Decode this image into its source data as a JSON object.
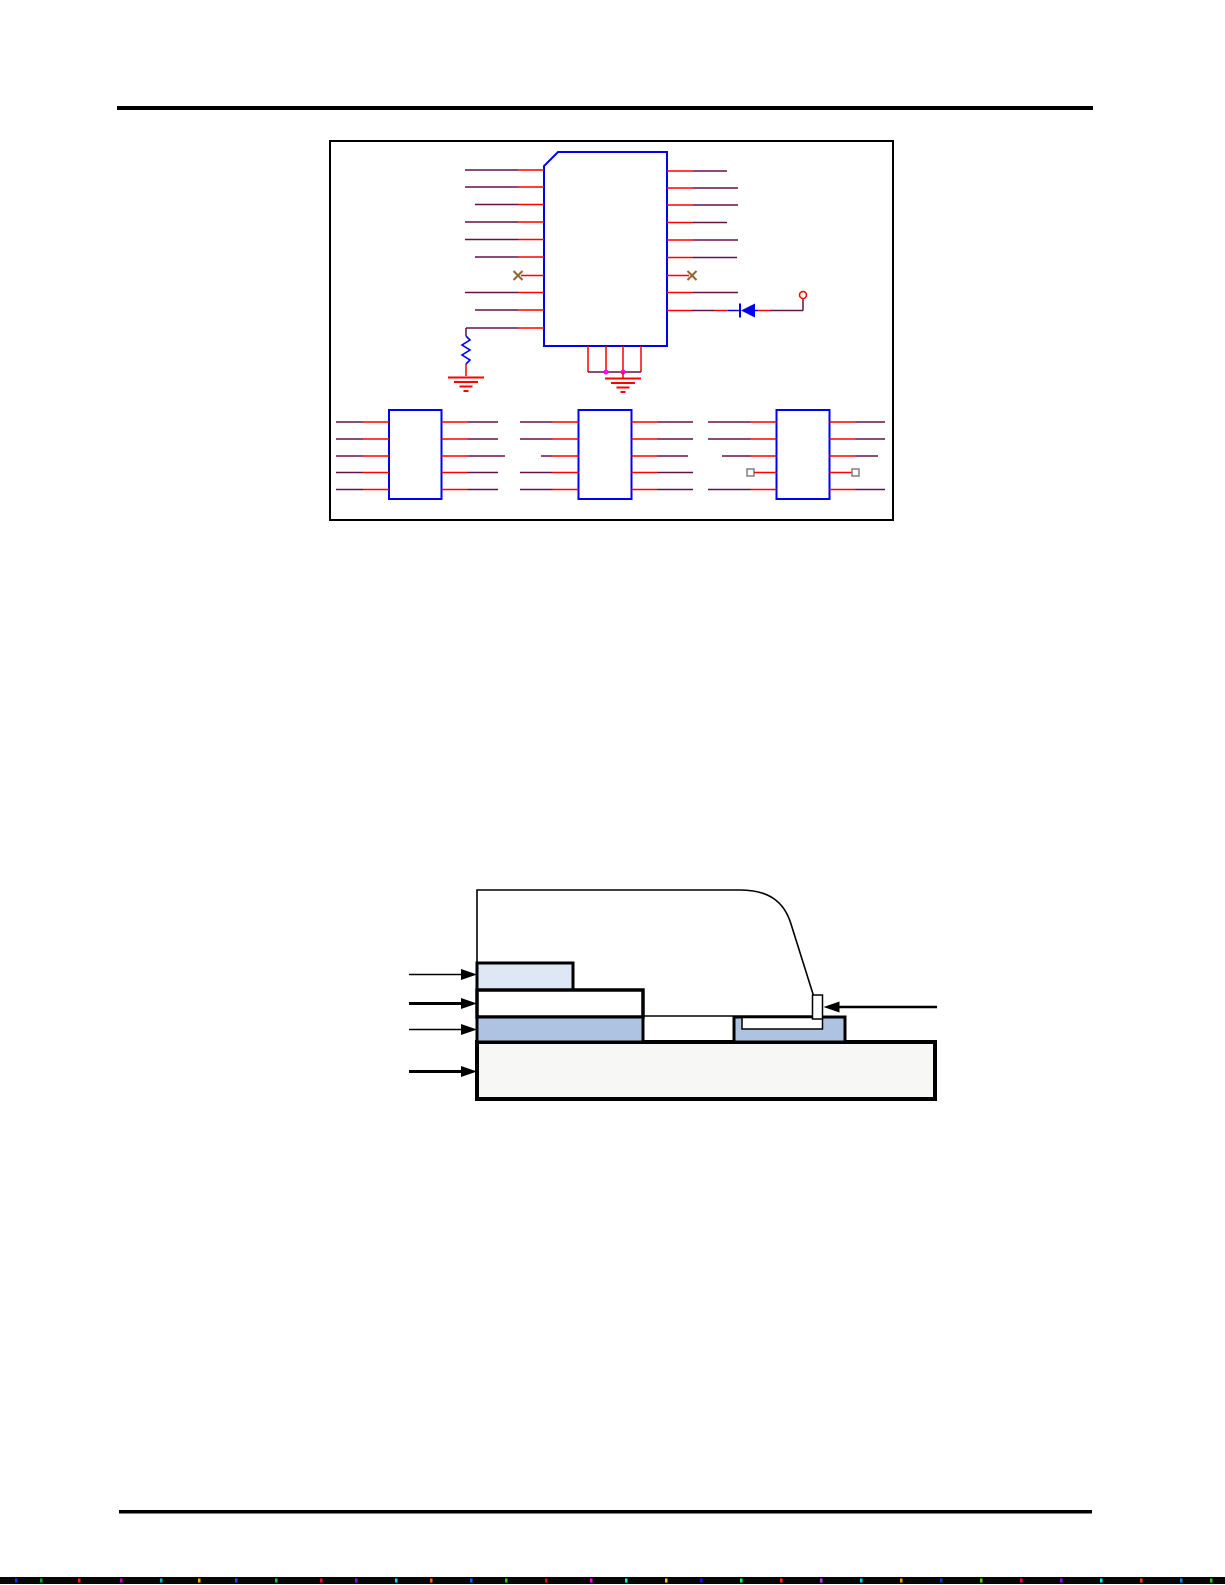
{
  "page": {
    "width": 1225,
    "height": 1585,
    "background": "#ffffff",
    "top_rule": {
      "x": 117,
      "y": 106,
      "w": 976,
      "h": 4,
      "color": "#000000"
    },
    "bottom_rule": {
      "x": 119,
      "y": 1510,
      "w": 973,
      "h": 3.5,
      "color": "#000000"
    },
    "noise_bar": {
      "x": 0,
      "y": 1577,
      "w": 1225,
      "h": 7,
      "color": "#060606",
      "specks": [
        {
          "x": 15,
          "c": "#0033ff"
        },
        {
          "x": 40,
          "c": "#00aa33"
        },
        {
          "x": 78,
          "c": "#ff2200"
        },
        {
          "x": 120,
          "c": "#cc00cc"
        },
        {
          "x": 160,
          "c": "#00bbbb"
        },
        {
          "x": 198,
          "c": "#ffaa00"
        },
        {
          "x": 235,
          "c": "#2244ff"
        },
        {
          "x": 275,
          "c": "#00cc44"
        },
        {
          "x": 320,
          "c": "#ff0044"
        },
        {
          "x": 355,
          "c": "#8800ff"
        },
        {
          "x": 395,
          "c": "#00ddff"
        },
        {
          "x": 430,
          "c": "#ff6600"
        },
        {
          "x": 470,
          "c": "#0066ff"
        },
        {
          "x": 505,
          "c": "#33cc00"
        },
        {
          "x": 545,
          "c": "#ff0000"
        },
        {
          "x": 590,
          "c": "#ff00ff"
        },
        {
          "x": 625,
          "c": "#00ffcc"
        },
        {
          "x": 665,
          "c": "#ffcc00"
        },
        {
          "x": 700,
          "c": "#3300ff"
        },
        {
          "x": 740,
          "c": "#00ff66"
        },
        {
          "x": 780,
          "c": "#ff3300"
        },
        {
          "x": 820,
          "c": "#cc33ff"
        },
        {
          "x": 860,
          "c": "#00ccff"
        },
        {
          "x": 900,
          "c": "#ff9900"
        },
        {
          "x": 940,
          "c": "#0044cc"
        },
        {
          "x": 980,
          "c": "#44dd00"
        },
        {
          "x": 1020,
          "c": "#ff0066"
        },
        {
          "x": 1060,
          "c": "#aa00ff"
        },
        {
          "x": 1100,
          "c": "#00eeff"
        },
        {
          "x": 1140,
          "c": "#ff4400"
        },
        {
          "x": 1180,
          "c": "#0088ff"
        },
        {
          "x": 1210,
          "c": "#22cc22"
        }
      ]
    }
  },
  "colors": {
    "wire": "#661045",
    "pin": "#ff0000",
    "device": "#0000f0",
    "nc_marker": "#996633",
    "junction": "#ff00ff",
    "port_square": "#808080",
    "frame": "#000000",
    "outline": "#000000"
  },
  "schematic": {
    "frame": {
      "x": 330,
      "y": 141,
      "w": 563,
      "h": 379
    },
    "main_ic": {
      "box": {
        "x": 544,
        "y": 152,
        "w": 123,
        "h": 194,
        "chamfer": 14
      },
      "stub": 26,
      "left_pins": [
        [
          170,
          465
        ],
        [
          187,
          465
        ],
        [
          204.5,
          475
        ],
        [
          222,
          465
        ],
        [
          239.5,
          465
        ],
        [
          257,
          475
        ],
        [
          275.5,
          "nc"
        ],
        [
          292.5,
          465
        ],
        [
          310,
          475
        ]
      ],
      "right_pins": [
        [
          171,
          727
        ],
        [
          188,
          738
        ],
        [
          205,
          738
        ],
        [
          222.5,
          727
        ],
        [
          240,
          738
        ],
        [
          257.5,
          737
        ],
        [
          275.5,
          "nc"
        ],
        [
          292.5,
          738
        ]
      ]
    },
    "resistor_branch": {
      "y": 328,
      "wire_x1": 466,
      "trans": 518,
      "box_x": 544,
      "res_x": 466,
      "drop_y2": 336,
      "res_y2": 364,
      "tail_y2": 376,
      "gnd_y": 377.5
    },
    "bottom_bus": {
      "pin_xs": [
        588,
        606,
        623,
        641
      ],
      "y1": 346,
      "y2": 372,
      "dots": [
        [
          606,
          372
        ],
        [
          623,
          372
        ]
      ],
      "stem": {
        "x": 623,
        "y1": 372,
        "y2": 378
      },
      "gnd": {
        "cx": 623,
        "y": 378.5
      }
    },
    "diode_branch": {
      "y": 310.5,
      "segments": [
        [
          "pin",
          667,
          692
        ],
        [
          "wire",
          692,
          714
        ],
        [
          "pin",
          714,
          728
        ],
        [
          "device",
          728,
          740
        ],
        [
          "device",
          755,
          758
        ],
        [
          "pin",
          758,
          770
        ],
        [
          "wire",
          770,
          803
        ]
      ],
      "diode": {
        "bar_x": 740,
        "apex_x": 741,
        "base_x": 755,
        "hh": 7
      },
      "riser": {
        "x": 803,
        "y1": 310.5,
        "y2": 298.5
      },
      "terminal": {
        "cx": 803,
        "cy": 295,
        "r": 3.5
      }
    },
    "sub_ics": [
      {
        "box": {
          "x": 389,
          "y": 410,
          "w": 52.5,
          "h": 89
        },
        "left_pins": [
          [
            422,
            336
          ],
          [
            439,
            336
          ],
          [
            456,
            336
          ],
          [
            472.5,
            336
          ],
          [
            489.5,
            336
          ]
        ],
        "right_pins": [
          [
            422,
            498
          ],
          [
            439,
            498
          ],
          [
            456,
            505
          ],
          [
            472.5,
            498
          ],
          [
            489.5,
            498
          ]
        ]
      },
      {
        "box": {
          "x": 578.5,
          "y": 410,
          "w": 53,
          "h": 89
        },
        "left_pins": [
          [
            422,
            520
          ],
          [
            439,
            520
          ],
          [
            456,
            541
          ],
          [
            472.5,
            520
          ],
          [
            489.5,
            520
          ]
        ],
        "right_pins": [
          [
            422,
            693
          ],
          [
            439,
            693
          ],
          [
            456,
            688
          ],
          [
            472.5,
            693
          ],
          [
            489.5,
            693
          ]
        ]
      },
      {
        "box": {
          "x": 776.5,
          "y": 410,
          "w": 53,
          "h": 89
        },
        "left_pins": [
          [
            422,
            708
          ],
          [
            439,
            708
          ],
          [
            456,
            722
          ],
          [
            472.5,
            "sq",
            750.5
          ],
          [
            489.5,
            708
          ]
        ],
        "right_pins": [
          [
            422,
            885
          ],
          [
            439,
            885
          ],
          [
            456,
            878
          ],
          [
            472.5,
            "sq",
            855.5
          ],
          [
            489.5,
            885
          ]
        ]
      }
    ]
  },
  "cross_section": {
    "body": {
      "path": "M 477 890 L 740 890 C 768 890 784 901 791 924 L 813 994 L 813 1016 L 477 1016 Z",
      "fill": "#ffffff",
      "sw": 1.6
    },
    "substrate": {
      "x": 477,
      "y": 1042,
      "w": 458,
      "h": 57,
      "fill": "#f7f7f5",
      "sw": 4
    },
    "layers": [
      {
        "name": "layer-top",
        "x": 477,
        "y": 963,
        "w": 96,
        "h": 27,
        "fill": "#dee8f5",
        "sw": 3
      },
      {
        "name": "layer-middle",
        "x": 477,
        "y": 990,
        "w": 166,
        "h": 27,
        "fill": "#ffffff",
        "sw": 3.5
      },
      {
        "name": "layer-bottom",
        "x": 477,
        "y": 1017,
        "w": 166,
        "h": 25,
        "fill": "#aec3e1",
        "sw": 3
      }
    ],
    "right_pad": {
      "x": 734,
      "y": 1017,
      "w": 111,
      "h": 25,
      "fill": "#aec3e1",
      "sw": 3
    },
    "inset_tray": {
      "x": 742,
      "y": 1017.5,
      "w": 80.5,
      "h": 11.5,
      "fill": "#ffffff",
      "sw": 1.5
    },
    "tab": {
      "x": 812.5,
      "y": 995,
      "w": 10,
      "h": 24,
      "fill": "#ffffff",
      "sw": 1.5
    },
    "arrows": [
      {
        "tip": 477,
        "tail": 409,
        "y": 974.5,
        "w": 1.5,
        "dir": "right"
      },
      {
        "tip": 477,
        "tail": 409,
        "y": 1003.5,
        "w": 3,
        "dir": "right"
      },
      {
        "tip": 477,
        "tail": 409,
        "y": 1029.5,
        "w": 1.5,
        "dir": "right"
      },
      {
        "tip": 477,
        "tail": 409,
        "y": 1071.5,
        "w": 3,
        "dir": "right"
      },
      {
        "tip": 823.5,
        "tail": 937,
        "y": 1007,
        "w": 2.5,
        "dir": "left"
      }
    ]
  }
}
